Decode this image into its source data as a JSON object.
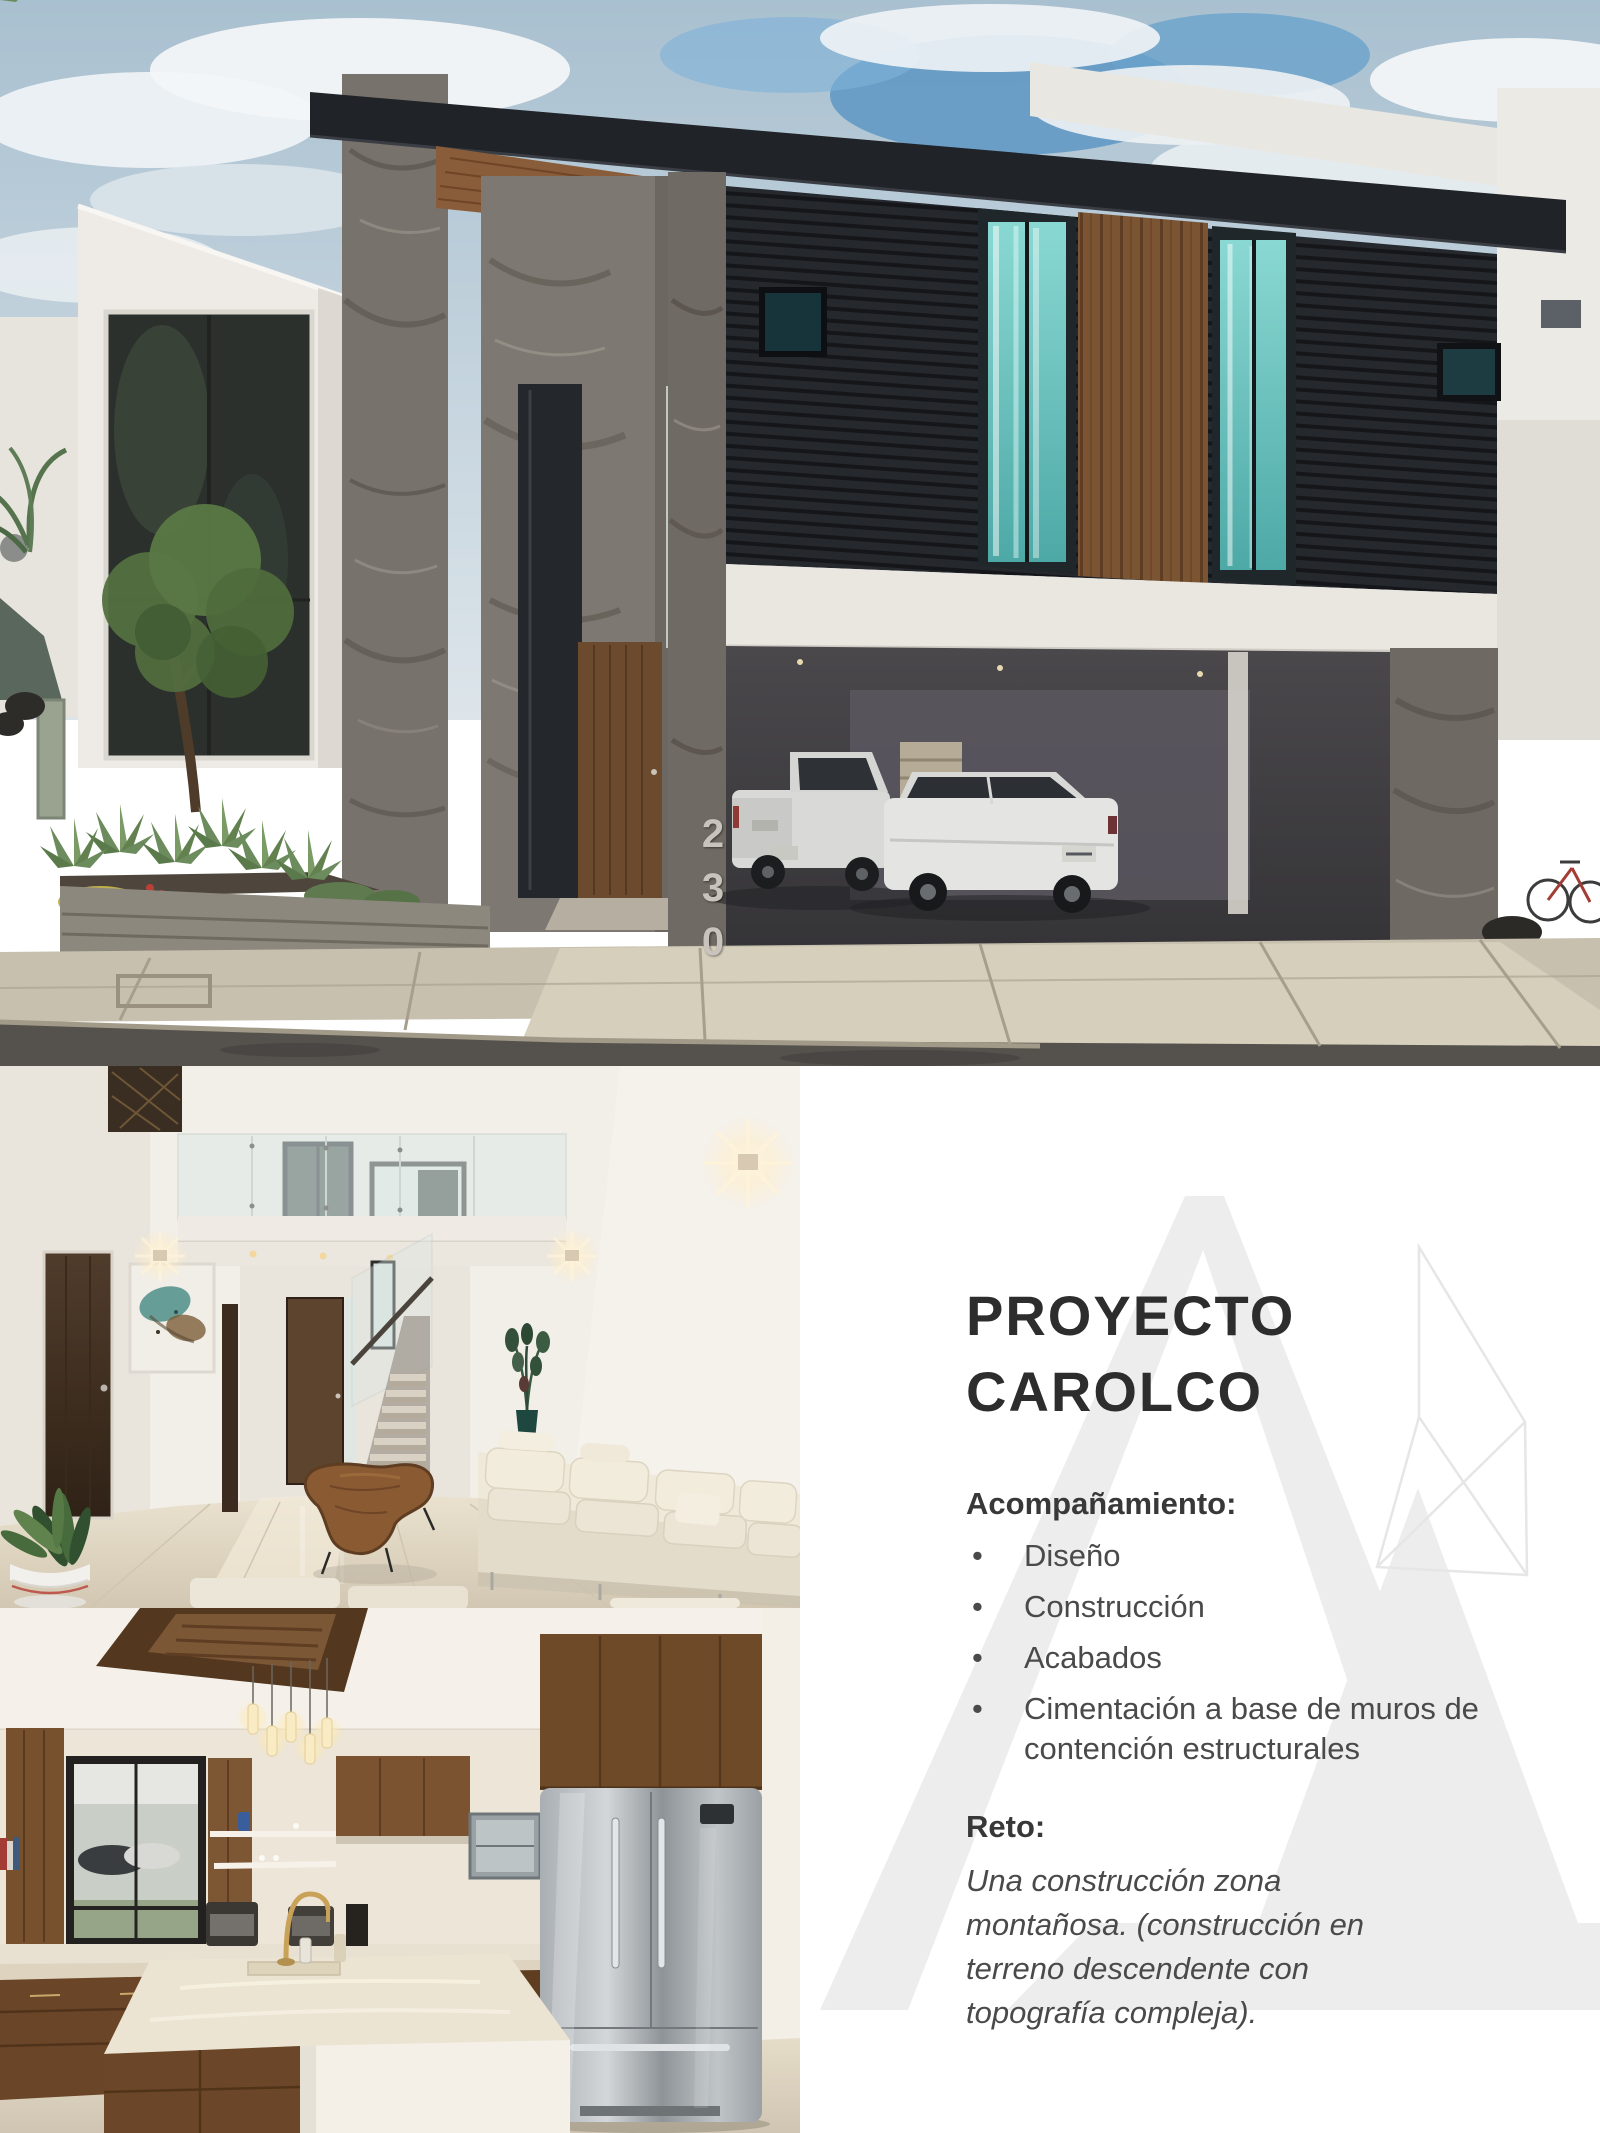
{
  "project_panel": {
    "title": {
      "line1": "PROYECTO",
      "line2": "CAROLCO"
    },
    "accompaniment": {
      "heading": "Acompañamiento:",
      "items": [
        "Diseño",
        "Construcción",
        "Acabados",
        "Cimentación a base de muros de contención estructurales"
      ]
    },
    "challenge": {
      "heading": "Reto:",
      "text": "Una construcción zona montañosa. (construcción en terreno descendente con topografía compleja)."
    }
  },
  "photos": {
    "facade": {
      "house_number": "230"
    }
  },
  "colors": {
    "title_text": "#2d2d2d",
    "body_text": "#4a4a4a",
    "watermark_gray": "#ededed",
    "sky_blue": "#5e97c3",
    "curtain_teal": "#74cdc9",
    "wood_brown": "#7a5334",
    "stone_gray": "#77726b"
  }
}
